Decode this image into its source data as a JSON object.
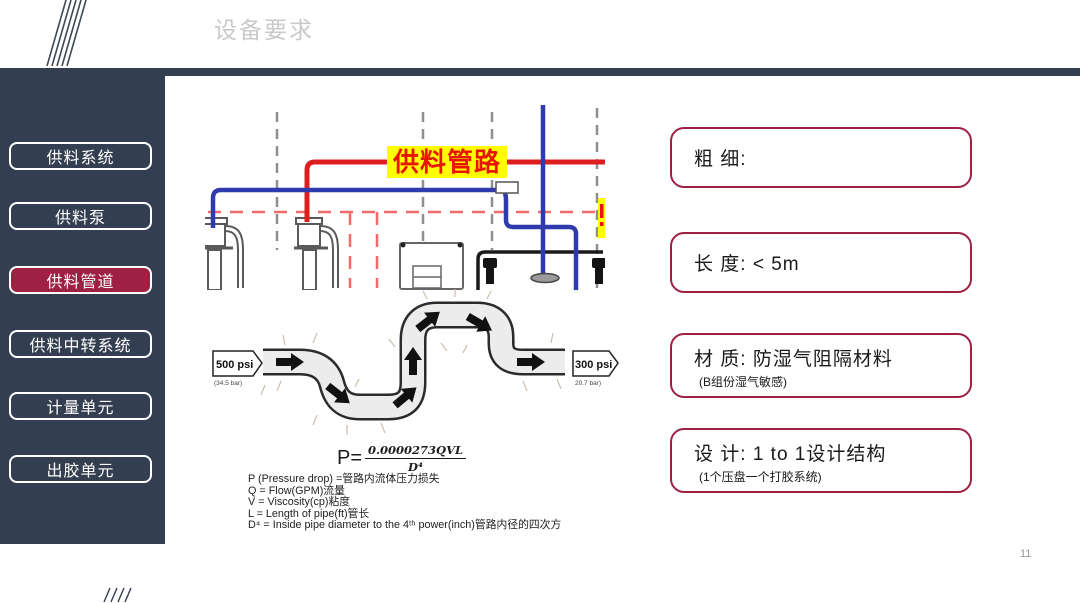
{
  "slide": {
    "title": "设备要求",
    "page_number": "11"
  },
  "sidebar": {
    "items": [
      {
        "label": "供料系统",
        "active": false
      },
      {
        "label": "供料泵",
        "active": false
      },
      {
        "label": "供料管道",
        "active": true
      },
      {
        "label": "供料中转系统",
        "active": false
      },
      {
        "label": "计量单元",
        "active": false
      },
      {
        "label": "出胶单元",
        "active": false
      }
    ]
  },
  "schematic": {
    "pipe_label": "供料管路"
  },
  "pipe_diagram": {
    "inlet_pressure": "500 psi",
    "inlet_pressure_bar": "(34.5 bar)",
    "outlet_pressure": "300 psi",
    "outlet_pressure_bar": "20.7 bar)"
  },
  "formula": {
    "lhs": "P=",
    "numerator": "0.0000273QVL",
    "denominator": "D⁴",
    "definitions": [
      "P (Pressure drop) =管路内流体压力损失",
      "Q = Flow(GPM)流量",
      "V = Viscosity(cp)粘度",
      "L = Length of pipe(ft)管长",
      "D⁴ = Inside pipe diameter to the 4ᵗʰ power(inch)管路内径的四次方"
    ]
  },
  "requirements": [
    {
      "title": "粗 细:",
      "subtitle": ""
    },
    {
      "title": "长 度:  < 5m",
      "subtitle": ""
    },
    {
      "title": "材 质:  防湿气阻隔材料",
      "subtitle": "(B组份湿气敏感)"
    },
    {
      "title": "设 计:  1 to 1设计结构",
      "subtitle": "(1个压盘一个打胶系统)"
    }
  ],
  "colors": {
    "dark": "#333F50",
    "accent": "#9E2144",
    "pipe_red": "#DC1E1E",
    "pipe_blue": "#2F3BAD",
    "highlight": "#FFFF00"
  }
}
